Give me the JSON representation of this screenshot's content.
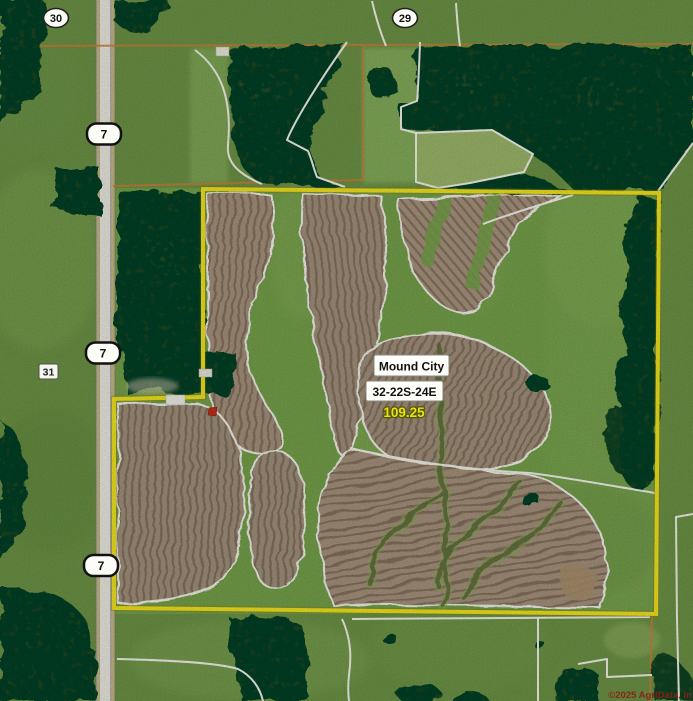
{
  "map": {
    "kind": "aerial-parcel-map",
    "sections": [
      {
        "label": "30"
      },
      {
        "label": "29"
      },
      {
        "label": "31"
      }
    ],
    "highway": {
      "route": "7"
    },
    "parcel": {
      "name": "Mound City",
      "township_range_section": "32-22S-24E",
      "acres": "109.25"
    },
    "copyright": "©2025 AgriData, In",
    "colors": {
      "boundary_yellow": "#f2e41f",
      "acres_text": "#e8e411",
      "section_line_orange": "#c9803a",
      "clu_line_white": "#f3f3ea",
      "copyright_red": "#8a2014",
      "field_tan": "#a6927d",
      "forest_green": "#33521f",
      "pasture_green": "#6d9346"
    }
  }
}
